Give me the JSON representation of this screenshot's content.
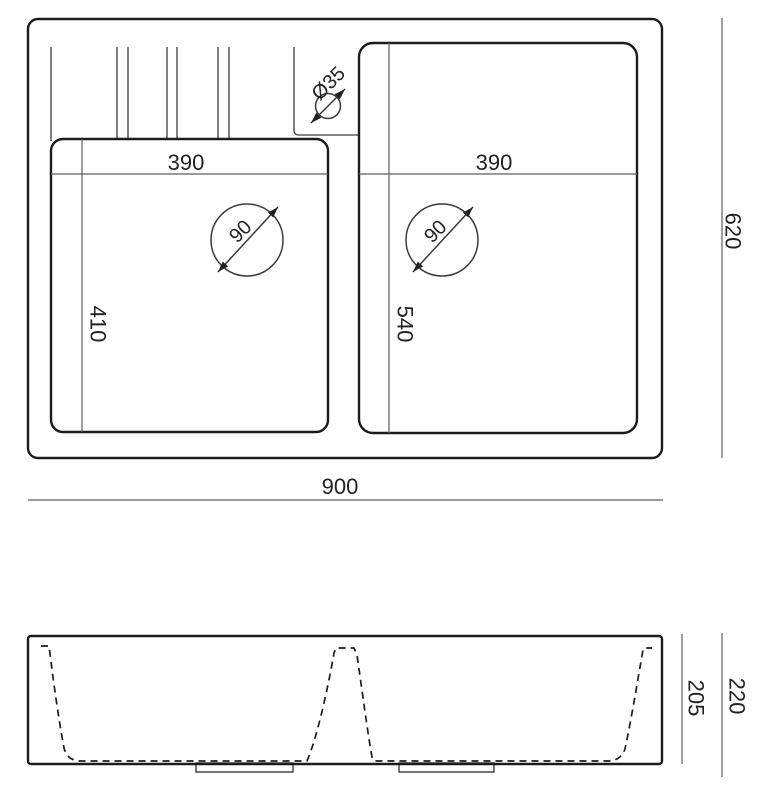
{
  "top_view": {
    "overall_width": "900",
    "overall_depth": "620",
    "left_bowl": {
      "width": "390",
      "depth": "410",
      "drain_diameter": "90"
    },
    "right_bowl": {
      "width": "390",
      "depth": "540",
      "drain_diameter": "90"
    },
    "faucet_hole_diameter": "Ø35"
  },
  "side_view": {
    "overall_height": "220",
    "bowl_depth": "205"
  },
  "colors": {
    "background": "#ffffff",
    "outline": "#1c1c1c",
    "detail_line": "#3c3c3c",
    "dimension_line": "#5f5f5f",
    "label_text": "#222222"
  }
}
